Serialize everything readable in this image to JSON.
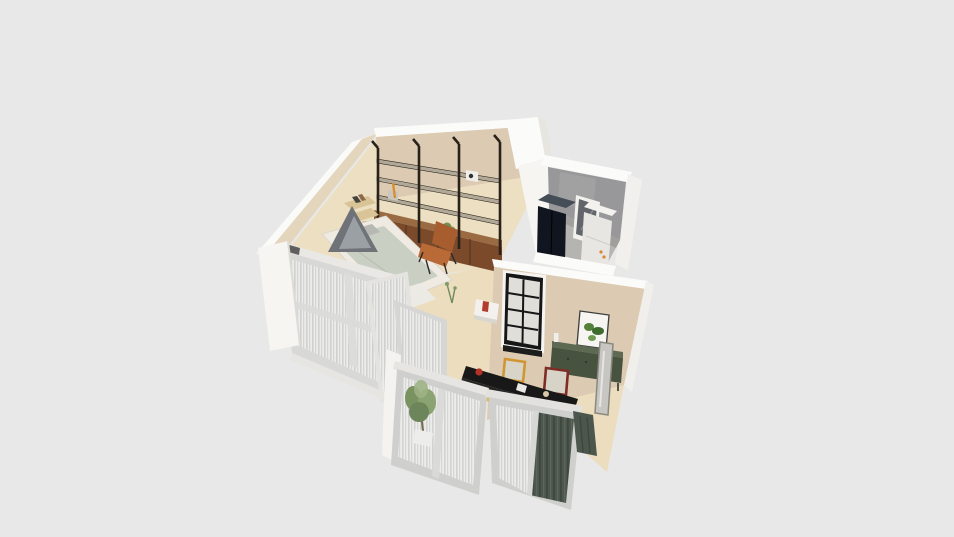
{
  "viewport": {
    "type": "3d-dollhouse-floorplan-render",
    "background": "#e8e8e8"
  },
  "colors": {
    "background": "#e8e8e8",
    "wall_white": "#fafaf8",
    "wall_white_shade": "#eceae5",
    "wall_beige": "#dccbb2",
    "wall_beige_top": "#e4d5bd",
    "floor_main": "#eddfc1",
    "floor_living": "#ecddbe",
    "floor_utility": "#b5b4b1",
    "wall_utility_gray": "#98989a",
    "shelf_metal": "#28221a",
    "shelf_board": "#b1a897",
    "cabinet_wood": "#7b4a2b",
    "cabinet_wood_top": "#9a6a42",
    "bed_frame": "#efebe3",
    "bed_duvet": "#c9cfc2",
    "tent_gray": "#6f7378",
    "chair_leather": "#b96a36",
    "chair_leather_dark": "#a85d2e",
    "corner_shelf_wood": "#d9c497",
    "navy_cabinet": "#10151f",
    "appliance_white": "#e7e6e3",
    "sideboard_green": "#48533f",
    "sideboard_green_top": "#5d6953",
    "window_frame_black": "#161616",
    "counter_black": "#181818",
    "frame_orange": "#cf9733",
    "frame_red": "#7e2d26",
    "curtain_sheer": "#ececea",
    "curtain_green": "#4c564c",
    "plant_green": "#8ba271",
    "door_frame_gray": "#cfcfcd",
    "kettle_red": "#b13227",
    "print_green": "#55803c",
    "mirror_glass": "#c7c6c2"
  },
  "rooms": {
    "bedroom_living": {
      "items": [
        "metal-wall-shelving",
        "wood-cabinet-row",
        "platform-bed",
        "canopy-tent",
        "pillows",
        "corner-wall-shelves",
        "leather-chair",
        "shelf-plant",
        "books"
      ]
    },
    "utility_room": {
      "items": [
        "navy-double-cabinet",
        "white-appliance",
        "glass-door",
        "concrete-wall"
      ]
    },
    "kitchen_dining": {
      "items": [
        "black-grid-window",
        "botanical-print",
        "green-sideboard",
        "leaning-mirror",
        "picture-frame-orange",
        "picture-frame-red",
        "kitchen-counter",
        "red-kettle",
        "coffee-machine",
        "wall-ledge",
        "red-vase"
      ]
    },
    "balconies": {
      "items": [
        "sliding-glass-door-left",
        "sliding-glass-door-right",
        "bedroom-window-wall",
        "open-window-panel",
        "sheer-curtains",
        "green-curtain",
        "potted-plant"
      ]
    }
  }
}
